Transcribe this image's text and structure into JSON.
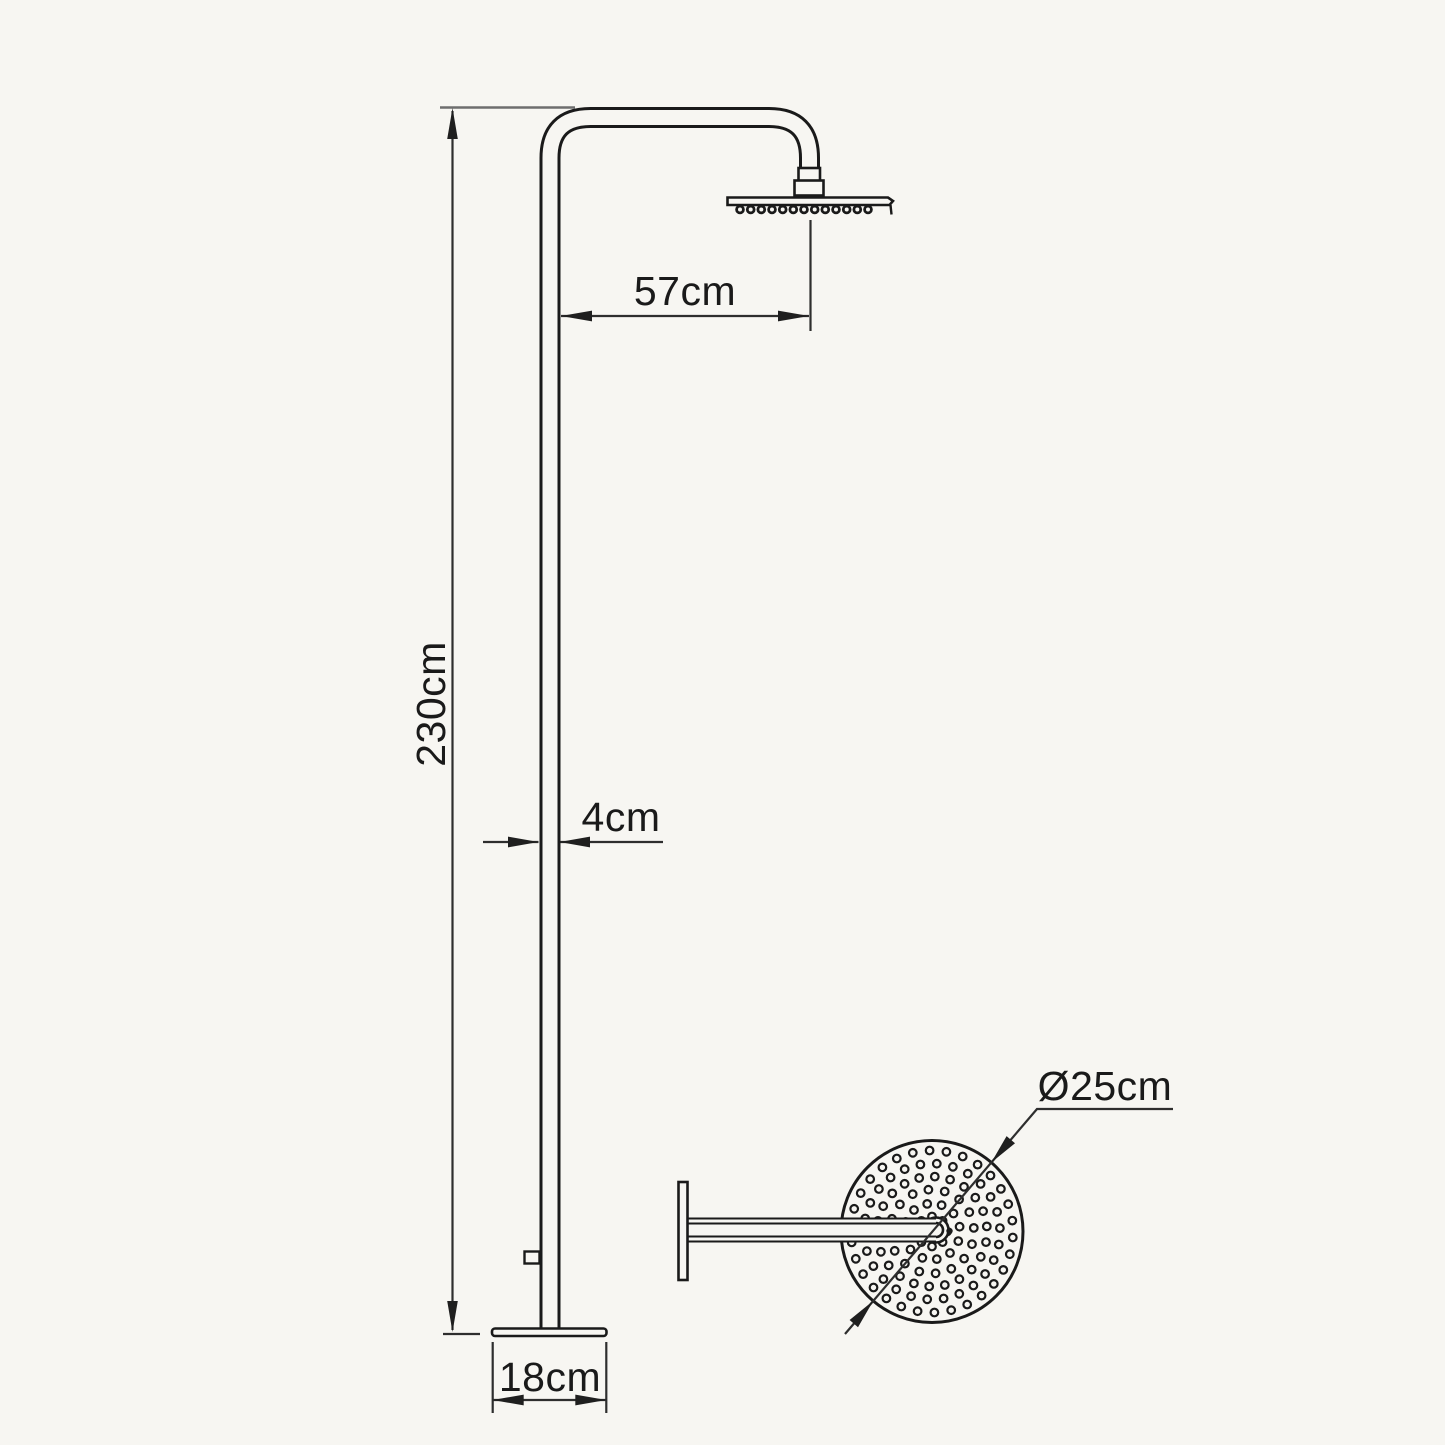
{
  "page": {
    "title": "Freestanding shower column technical drawing",
    "background": "#f7f6f2"
  },
  "drawing": {
    "line_color": "#1a1a1a",
    "dimension_color": "#2e2e2e",
    "extension_color": "#6e6e6e"
  },
  "labels": {
    "height": "230cm",
    "reach": "57cm",
    "pipe": "4cm",
    "base": "18cm",
    "head": "Ø25cm"
  },
  "top_view": {
    "cx": 932,
    "cy": 1231.5,
    "radius": 91,
    "hole_radius": 3.8,
    "hole_stroke": 2.2,
    "hole_rings": [
      {
        "r": 15,
        "count": 8
      },
      {
        "r": 28,
        "count": 12
      },
      {
        "r": 42,
        "count": 16
      },
      {
        "r": 55,
        "count": 22
      },
      {
        "r": 68,
        "count": 26
      },
      {
        "r": 81,
        "count": 30
      }
    ]
  },
  "side_view": {
    "nozzles": {
      "count": 13,
      "x_start": 740,
      "x_end": 868,
      "y": 209.5,
      "radius": 3.4,
      "stroke": 2.8
    }
  }
}
